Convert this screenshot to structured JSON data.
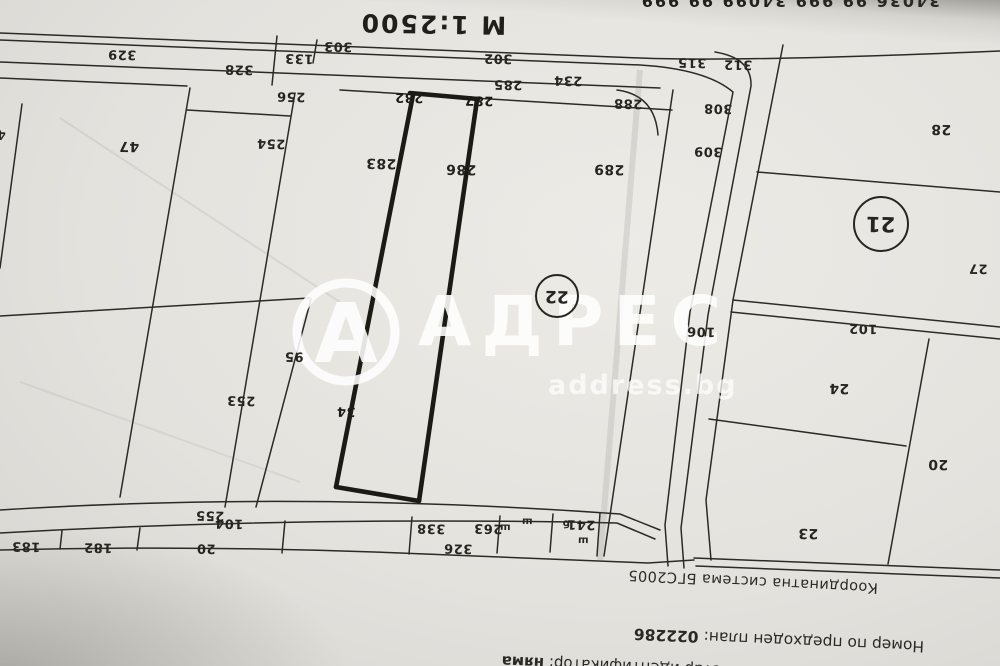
{
  "photo": {
    "top_cut_text": "34036 99 999   34099 99 999",
    "scale_text": "М 1:2500"
  },
  "watermark": {
    "brand": "АДРЕС",
    "domain": "address.bg",
    "logo_letter": "А"
  },
  "map": {
    "circled_labels": [
      {
        "text": "22"
      },
      {
        "text": "21"
      }
    ],
    "parcel_labels": [
      {
        "text": "329"
      },
      {
        "text": "328"
      },
      {
        "text": "133"
      },
      {
        "text": "303"
      },
      {
        "text": "302"
      },
      {
        "text": "285"
      },
      {
        "text": "234"
      },
      {
        "text": "315"
      },
      {
        "text": "312"
      },
      {
        "text": "288"
      },
      {
        "text": "308"
      },
      {
        "text": "309"
      },
      {
        "text": "256"
      },
      {
        "text": "254"
      },
      {
        "text": "47"
      },
      {
        "text": "283"
      },
      {
        "text": "282"
      },
      {
        "text": "287"
      },
      {
        "text": "286"
      },
      {
        "text": "289"
      },
      {
        "text": "95"
      },
      {
        "text": "34"
      },
      {
        "text": "253"
      },
      {
        "text": "106"
      },
      {
        "text": "28"
      },
      {
        "text": "27"
      },
      {
        "text": "102"
      },
      {
        "text": "24"
      },
      {
        "text": "20"
      },
      {
        "text": "23"
      },
      {
        "text": "255"
      },
      {
        "text": "104"
      },
      {
        "text": "20"
      },
      {
        "text": "182"
      },
      {
        "text": "183"
      },
      {
        "text": "338"
      },
      {
        "text": "263"
      },
      {
        "text": "326"
      },
      {
        "text": "241"
      },
      {
        "text": "4"
      }
    ],
    "terrain_marks": [
      {
        "text": "ш"
      },
      {
        "text": "ш"
      },
      {
        "text": "ш"
      },
      {
        "text": "б"
      }
    ]
  },
  "footer": {
    "coord_system": "Координатна система БГС2005",
    "prev_plan_label": "Номер по предходен план:",
    "prev_plan_number": "022286",
    "old_id_label": "Стар идентификатор:",
    "old_id_value": "няма"
  },
  "colors": {
    "ink": "#26251f",
    "paper": "#e4e2dd",
    "watermark": "#ffffff"
  }
}
